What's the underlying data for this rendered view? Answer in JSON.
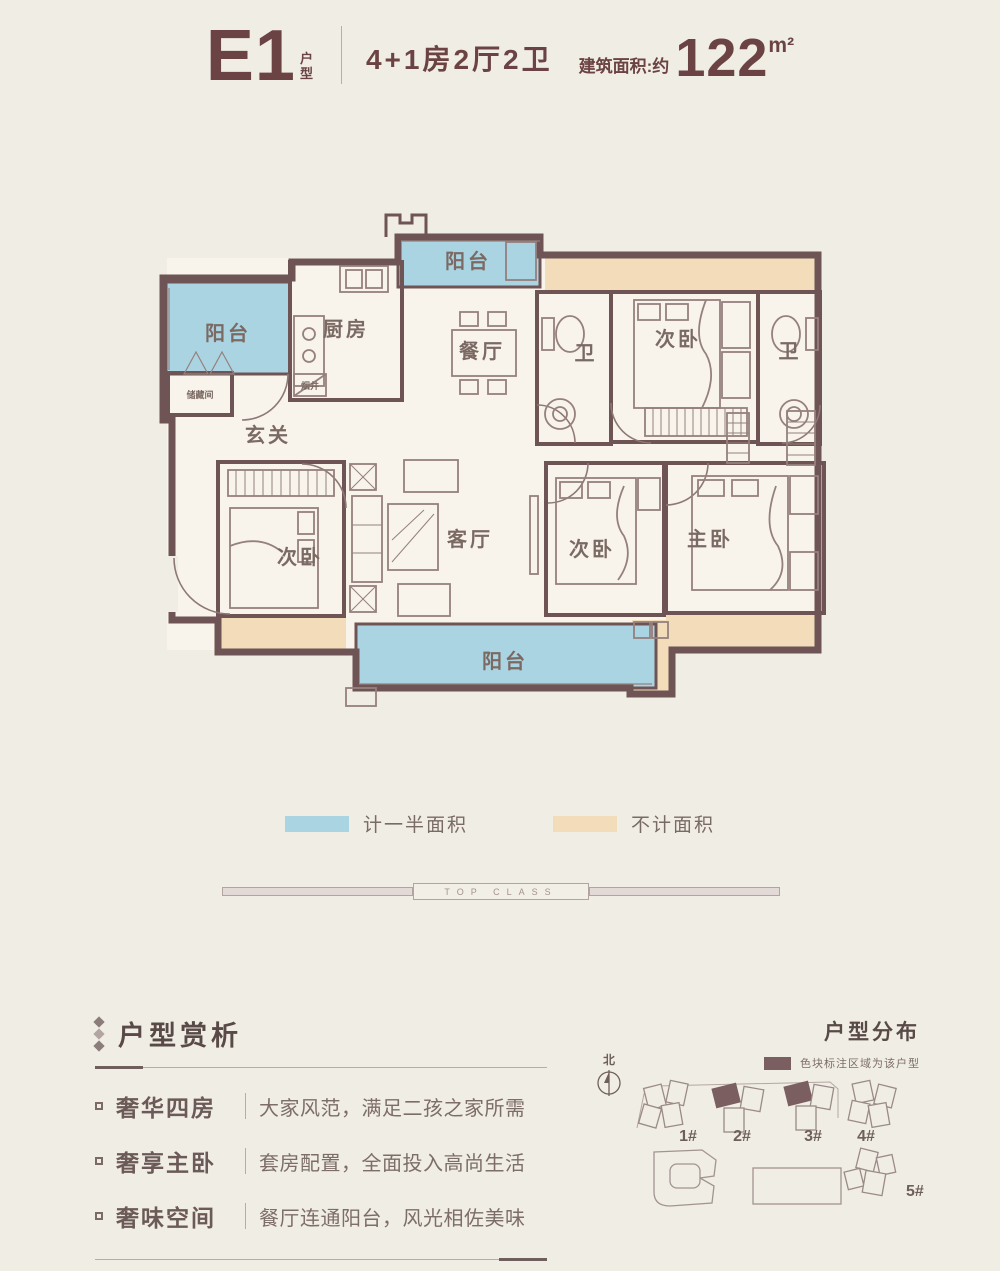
{
  "header": {
    "plan_code": "E1",
    "plan_type_chars": [
      "户",
      "型"
    ],
    "layout": "4+1房2厅2卫",
    "area_prefix": "建筑面积:约",
    "area_value": "122",
    "area_unit": "m²"
  },
  "floorplan": {
    "rooms": {
      "balcony": "阳台",
      "storage": "储藏间",
      "flue": "烟井",
      "kitchen": "厨房",
      "dining": "餐厅",
      "entry": "玄关",
      "bath": "卫",
      "bedroom": "次卧",
      "living": "客厅",
      "master": "主卧"
    }
  },
  "legend": {
    "half_area": {
      "label": "计一半面积",
      "color": "#abd4e2"
    },
    "excluded_area": {
      "label": "不计面积",
      "color": "#f2dcba"
    }
  },
  "divider_text": "TOP CLASS",
  "analysis": {
    "title": "户型赏析",
    "items": [
      {
        "title": "奢华四房",
        "desc": "大家风范，满足二孩之家所需"
      },
      {
        "title": "奢享主卧",
        "desc": "套房配置，全面投入高尚生活"
      },
      {
        "title": "奢味空间",
        "desc": "餐厅连通阳台，风光相佐美味"
      }
    ]
  },
  "distribution": {
    "title": "户型分布",
    "legend": "色块标注区域为该户型",
    "north": "北",
    "buildings": [
      "1#",
      "2#",
      "3#",
      "4#",
      "5#"
    ]
  },
  "icons": {
    "analysis_marker": "diamond-chain-icon",
    "bullet_marker": "square-icon",
    "north_marker": "compass-icon"
  },
  "colors": {
    "background": "#f0ede4",
    "wall": "#6f5455",
    "accent_text": "#6b4344",
    "half_area_blue": "#abd4e2",
    "excluded_tan": "#f2dcba",
    "highlight_unit": "#7b5f60"
  }
}
